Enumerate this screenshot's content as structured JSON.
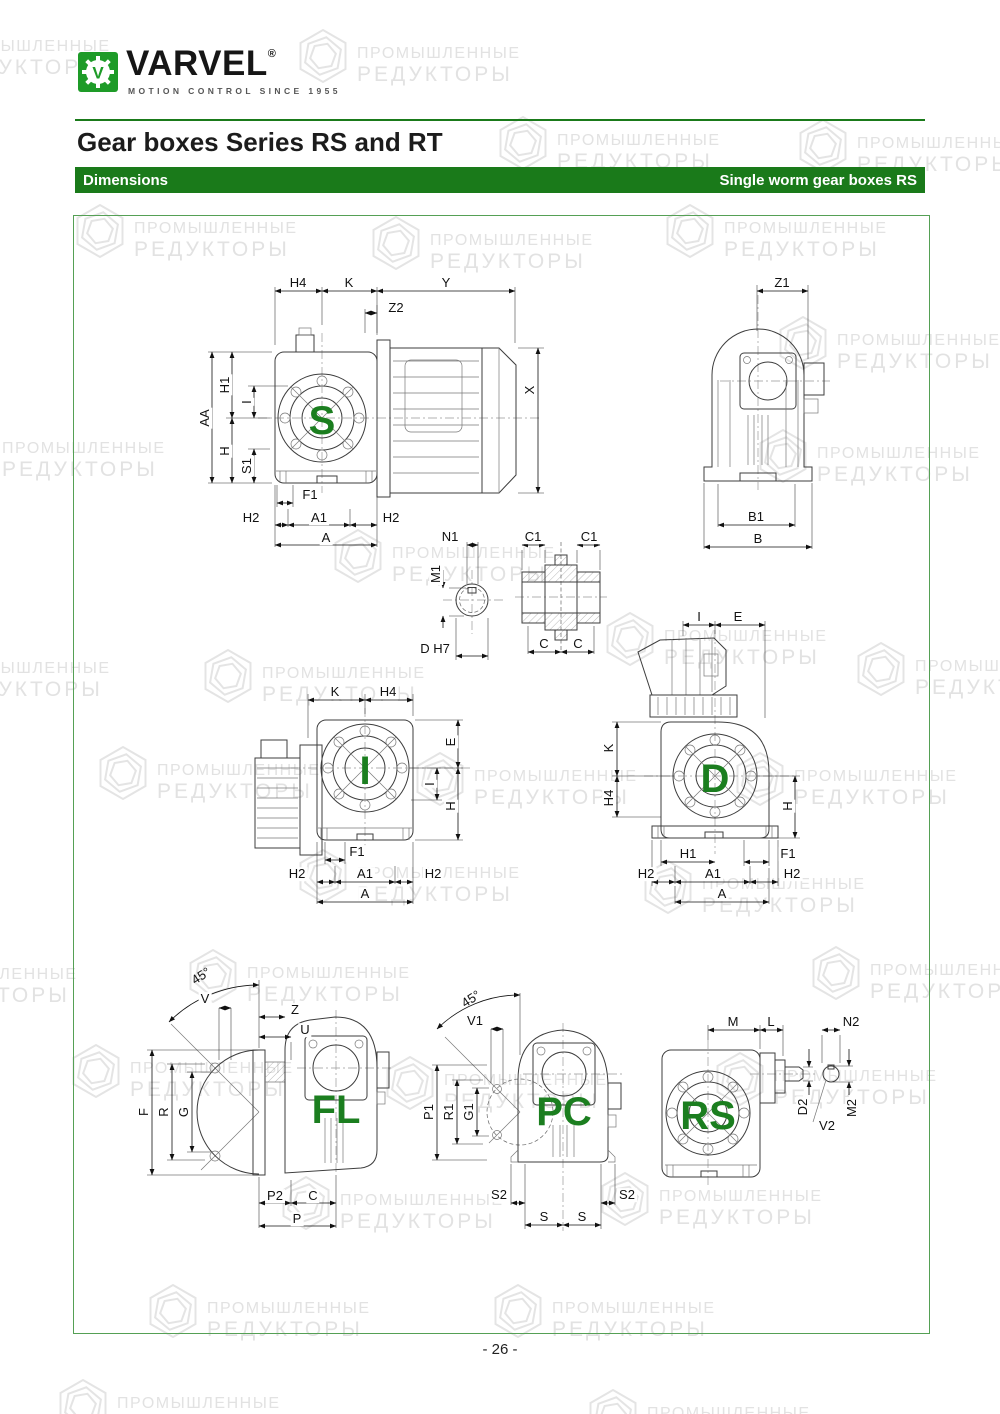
{
  "header": {
    "brand": "VARVEL",
    "brand_reg": "®",
    "tagline": "MOTION CONTROL SINCE 1955",
    "title": "Gear boxes Series RS and RT",
    "bar_left": "Dimensions",
    "bar_right": "Single worm gear boxes RS"
  },
  "footer": {
    "page_number": "- 26 -"
  },
  "colors": {
    "green_bar": "#1a7a1a",
    "logo_green": "#1e9b28",
    "letter_green": "#1b7e1f",
    "watermark_gray": "#e2e2e2",
    "line_gray": "#3d3d3d"
  },
  "watermark": {
    "line1": "ПРОМЫШЛЕННЫЕ",
    "line2": "РЕДУКТОРЫ",
    "positions": [
      [
        -115,
        18
      ],
      [
        295,
        25
      ],
      [
        495,
        112
      ],
      [
        795,
        115
      ],
      [
        72,
        200
      ],
      [
        368,
        212
      ],
      [
        662,
        200
      ],
      [
        775,
        312
      ],
      [
        -60,
        420
      ],
      [
        755,
        425
      ],
      [
        330,
        525
      ],
      [
        602,
        608
      ],
      [
        -115,
        640
      ],
      [
        853,
        638
      ],
      [
        200,
        645
      ],
      [
        95,
        742
      ],
      [
        412,
        748
      ],
      [
        732,
        748
      ],
      [
        295,
        845
      ],
      [
        640,
        856
      ],
      [
        -148,
        946
      ],
      [
        185,
        945
      ],
      [
        808,
        942
      ],
      [
        68,
        1040
      ],
      [
        382,
        1052
      ],
      [
        712,
        1048
      ],
      [
        278,
        1172
      ],
      [
        597,
        1168
      ],
      [
        145,
        1280
      ],
      [
        490,
        1280
      ],
      [
        55,
        1375
      ],
      [
        585,
        1385
      ]
    ]
  },
  "drawings": {
    "s": {
      "version": "S",
      "labels": [
        {
          "t": "H4",
          "x": 98,
          "y": 8
        },
        {
          "t": "K",
          "x": 149,
          "y": 8
        },
        {
          "t": "Y",
          "x": 246,
          "y": 8
        },
        {
          "t": "Z2",
          "x": 196,
          "y": 33
        },
        {
          "t": "X",
          "x": 330,
          "y": 115,
          "r": -90
        },
        {
          "t": "AA",
          "x": 5,
          "y": 143,
          "r": -90
        },
        {
          "t": "H1",
          "x": 25,
          "y": 110,
          "r": -90
        },
        {
          "t": "I",
          "x": 47,
          "y": 127,
          "r": -90
        },
        {
          "t": "H",
          "x": 25,
          "y": 176,
          "r": -90
        },
        {
          "t": "S1",
          "x": 47,
          "y": 191,
          "r": -90
        },
        {
          "t": "F1",
          "x": 110,
          "y": 220
        },
        {
          "t": "H2",
          "x": 51,
          "y": 243
        },
        {
          "t": "A1",
          "x": 119,
          "y": 243
        },
        {
          "t": "H2",
          "x": 191,
          "y": 243
        },
        {
          "t": "A",
          "x": 126,
          "y": 263
        },
        {
          "t": "S",
          "x": 122,
          "y": 146,
          "c": "big"
        }
      ]
    },
    "b": {
      "version": "B",
      "labels": [
        {
          "t": "Z1",
          "x": 92,
          "y": 8
        },
        {
          "t": "B1",
          "x": 66,
          "y": 242
        },
        {
          "t": "B",
          "x": 68,
          "y": 264
        }
      ]
    },
    "n": {
      "version": "shaft-bore",
      "labels": [
        {
          "t": "N1",
          "x": 45,
          "y": 7
        },
        {
          "t": "M1",
          "x": 31,
          "y": 44,
          "r": -90
        },
        {
          "t": "D H7",
          "x": 30,
          "y": 119
        }
      ]
    },
    "c": {
      "version": "hollow-shaft",
      "labels": [
        {
          "t": "C1",
          "x": 18,
          "y": 7
        },
        {
          "t": "C1",
          "x": 74,
          "y": 7
        },
        {
          "t": "C",
          "x": 29,
          "y": 114
        },
        {
          "t": "C",
          "x": 63,
          "y": 114
        }
      ]
    },
    "i": {
      "version": "I",
      "labels": [
        {
          "t": "K",
          "x": 90,
          "y": 12
        },
        {
          "t": "H4",
          "x": 143,
          "y": 12
        },
        {
          "t": "E",
          "x": 206,
          "y": 62,
          "r": -90
        },
        {
          "t": "I",
          "x": 185,
          "y": 104,
          "r": -90
        },
        {
          "t": "H",
          "x": 206,
          "y": 126,
          "r": -90
        },
        {
          "t": "F1",
          "x": 112,
          "y": 172
        },
        {
          "t": "H2",
          "x": 52,
          "y": 194
        },
        {
          "t": "A1",
          "x": 120,
          "y": 194
        },
        {
          "t": "H2",
          "x": 188,
          "y": 194
        },
        {
          "t": "A",
          "x": 120,
          "y": 214
        },
        {
          "t": "I",
          "x": 120,
          "y": 91,
          "c": "big"
        }
      ]
    },
    "d": {
      "version": "D",
      "labels": [
        {
          "t": "I",
          "x": 99,
          "y": 7
        },
        {
          "t": "E",
          "x": 138,
          "y": 7
        },
        {
          "t": "K",
          "x": 9,
          "y": 138,
          "r": -90
        },
        {
          "t": "H4",
          "x": 9,
          "y": 188,
          "r": -90
        },
        {
          "t": "H",
          "x": 188,
          "y": 196,
          "r": -90
        },
        {
          "t": "H1",
          "x": 88,
          "y": 244
        },
        {
          "t": "F1",
          "x": 188,
          "y": 244
        },
        {
          "t": "H2",
          "x": 46,
          "y": 264
        },
        {
          "t": "A1",
          "x": 113,
          "y": 264
        },
        {
          "t": "H2",
          "x": 192,
          "y": 264
        },
        {
          "t": "A",
          "x": 122,
          "y": 284
        },
        {
          "t": "D",
          "x": 115,
          "y": 169,
          "c": "big"
        }
      ]
    },
    "fl": {
      "version": "FL",
      "labels": [
        {
          "t": "45°",
          "x": 66,
          "y": 16,
          "r": -33,
          "c": "ang"
        },
        {
          "t": "V",
          "x": 70,
          "y": 39
        },
        {
          "t": "Z",
          "x": 160,
          "y": 50
        },
        {
          "t": "U",
          "x": 170,
          "y": 70
        },
        {
          "t": "F",
          "x": 9,
          "y": 152,
          "r": -90
        },
        {
          "t": "R",
          "x": 29,
          "y": 152,
          "r": -90
        },
        {
          "t": "G",
          "x": 49,
          "y": 152,
          "r": -90
        },
        {
          "t": "P2",
          "x": 140,
          "y": 236
        },
        {
          "t": "C",
          "x": 178,
          "y": 236
        },
        {
          "t": "P",
          "x": 162,
          "y": 259
        },
        {
          "t": "FL",
          "x": 201,
          "y": 150,
          "c": "big"
        }
      ]
    },
    "pc": {
      "version": "PC",
      "labels": [
        {
          "t": "45°",
          "x": 46,
          "y": 14,
          "r": -33,
          "c": "ang"
        },
        {
          "t": "V1",
          "x": 50,
          "y": 36
        },
        {
          "t": "P1",
          "x": 4,
          "y": 127,
          "r": -90
        },
        {
          "t": "R1",
          "x": 24,
          "y": 127,
          "r": -90
        },
        {
          "t": "G1",
          "x": 44,
          "y": 127,
          "r": -90
        },
        {
          "t": "S2",
          "x": 74,
          "y": 210
        },
        {
          "t": "S2",
          "x": 202,
          "y": 210
        },
        {
          "t": "S",
          "x": 119,
          "y": 232
        },
        {
          "t": "S",
          "x": 157,
          "y": 232
        },
        {
          "t": "PC",
          "x": 139,
          "y": 127,
          "c": "big"
        }
      ]
    },
    "rs": {
      "version": "RS",
      "labels": [
        {
          "t": "M",
          "x": 78,
          "y": 17
        },
        {
          "t": "L",
          "x": 116,
          "y": 17
        },
        {
          "t": "N2",
          "x": 196,
          "y": 17
        },
        {
          "t": "D2",
          "x": 148,
          "y": 102,
          "r": -90
        },
        {
          "t": "M2",
          "x": 197,
          "y": 103,
          "r": -90
        },
        {
          "t": "V2",
          "x": 172,
          "y": 121
        },
        {
          "t": "RS",
          "x": 53,
          "y": 111,
          "c": "big"
        }
      ]
    }
  }
}
